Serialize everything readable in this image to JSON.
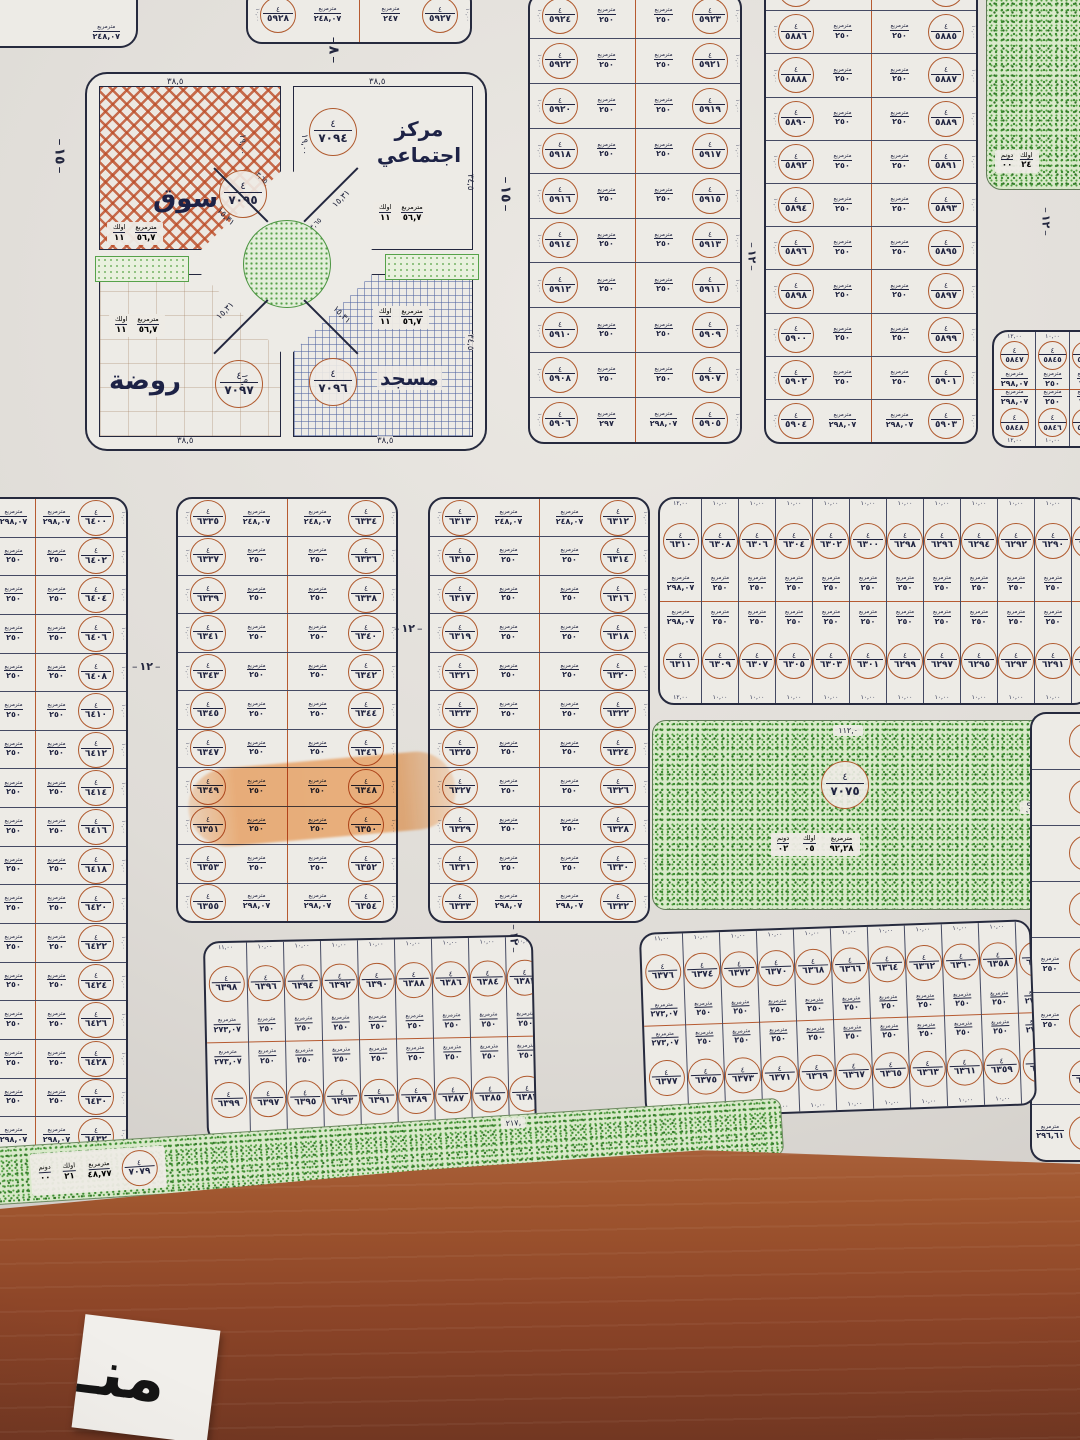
{
  "colors": {
    "paper": "#dfdcd7",
    "ink": "#1f2340",
    "plot_ring": "#b05a2e",
    "green": "#3c8a30",
    "brown_road": "#8d4528",
    "highlighter": "#f6923c"
  },
  "units": {
    "block_no": "٤",
    "m2": "مترمربع",
    "evlek": "اولك",
    "donum": "دونم"
  },
  "streets": {
    "w15": "١٥",
    "w8": "٨",
    "w12": "١٢"
  },
  "misc": {
    "corner_area": "٢٤٨,٠٧",
    "strip_length": "٢١٧,",
    "park_top_dim": "١١٢,٠",
    "park_side_dim": "٥٠,",
    "east_plot_no": "٦٢٧٧",
    "east_plot_area": "٢٩٦,٦١"
  },
  "bottom_label": {
    "text": "منـ"
  },
  "services": {
    "unit_stamp": [
      [
        "مترمربع",
        "٥٦,٧"
      ],
      [
        "اولك",
        "١١"
      ]
    ],
    "market": {
      "name": "سوق",
      "no": "٧٠٩٥",
      "dim_top": "٣٨,٥",
      "dim_side": "١٩,٠٠",
      "dim_diag": "١٥,٣١",
      "dim_chamfer": "٣,٦٥"
    },
    "community_center": {
      "name": "مركز اجتماعي",
      "no": "٧٠٩٤",
      "dim_top": "٣٨,٥",
      "dim_right": "٣٤,٥",
      "dim_side": "١٩,٠٠",
      "dim_diag": "١٥,٣١",
      "dim_chamfer": "٣,٦٥"
    },
    "kindergarten": {
      "name": "روضة",
      "no": "٧٠٩٧",
      "dim_top": "٢٤,٠٠",
      "dim_bottom": "٣٨,٥",
      "dim_side": "١٩,٠٠",
      "dim_diag": "١٥,٣١"
    },
    "mosque": {
      "name": "مسجد",
      "no": "٧٠٩٦",
      "dim_top": "٢٤,٠٠",
      "dim_bottom": "٣٨,٥",
      "dim_right": "٣٤,٥",
      "dim_diag": "١٥,٣١"
    }
  },
  "parks": {
    "central": {
      "no": "٧٠٧٥",
      "units": [
        [
          "مترمربع",
          "٩٢,٢٨"
        ],
        [
          "اولك",
          "٠٥"
        ],
        [
          "دونم",
          "٠٢"
        ]
      ]
    },
    "south_strip": {
      "no": "٧٠٧٩",
      "units": [
        [
          "مترمربع",
          "٤٨,٧٧"
        ],
        [
          "اولك",
          "٢١"
        ],
        [
          "دونم",
          "٠٠"
        ]
      ]
    },
    "ne_patch": {
      "units": [
        [
          "اولك",
          "٢٤"
        ],
        [
          "دونم",
          "٠٠"
        ]
      ]
    }
  },
  "blocks": {
    "nw_partial": {
      "edge": "١٠,٠٠",
      "area": "٢٥٠",
      "rows": [
        [
          "٥٩٢٨",
          "٥٩٢٧",
          "٢٤٨,٠٧",
          "٢٤٧"
        ]
      ]
    },
    "north_mid": {
      "edge": "١٠,٠٠",
      "area": "٢٥٠",
      "rows": [
        [
          "٥٩٢٤",
          "٥٩٢٣",
          null,
          null
        ],
        [
          "٥٩٢٢",
          "٥٩٢١",
          null,
          null
        ],
        [
          "٥٩٢٠",
          "٥٩١٩",
          null,
          null
        ],
        [
          "٥٩١٨",
          "٥٩١٧",
          null,
          null
        ],
        [
          "٥٩١٦",
          "٥٩١٥",
          null,
          null
        ],
        [
          "٥٩١٤",
          "٥٩١٣",
          null,
          null
        ],
        [
          "٥٩١٢",
          "٥٩١١",
          null,
          null
        ],
        [
          "٥٩١٠",
          "٥٩٠٩",
          null,
          null
        ],
        [
          "٥٩٠٨",
          "٥٩٠٧",
          null,
          null
        ],
        [
          "٥٩٠٦",
          "٥٩٠٥",
          "٢٩٧",
          "٢٩٨,٠٧"
        ]
      ]
    },
    "north_right": {
      "edge": "١٠,٠٠",
      "area": "٢٥٠",
      "rows": [
        [
          "٥٨٨٤",
          "٥٨٨٣",
          "٢٤٨,٠٧",
          "٢٤٨,٠٧"
        ],
        [
          "٥٨٨٦",
          "٥٨٨٥",
          null,
          null
        ],
        [
          "٥٨٨٨",
          "٥٨٨٧",
          null,
          null
        ],
        [
          "٥٨٩٠",
          "٥٨٨٩",
          null,
          null
        ],
        [
          "٥٨٩٢",
          "٥٨٩١",
          null,
          null
        ],
        [
          "٥٨٩٤",
          "٥٨٩٣",
          null,
          null
        ],
        [
          "٥٨٩٦",
          "٥٨٩٥",
          null,
          null
        ],
        [
          "٥٨٩٨",
          "٥٨٩٧",
          null,
          null
        ],
        [
          "٥٩٠٠",
          "٥٨٩٩",
          null,
          null
        ],
        [
          "٥٩٠٢",
          "٥٩٠١",
          null,
          null
        ],
        [
          "٥٩٠٤",
          "٥٩٠٣",
          "٢٩٨,٠٧",
          "٢٩٨,٠٧"
        ]
      ]
    },
    "northeast_small": {
      "width": "١٠,٠٠",
      "area": "٢٥٠",
      "cols": [
        [
          "٥٨٤٧",
          "٥٨٤٨",
          "٢٩٨,٠٧",
          "١٢,٠٠"
        ],
        [
          "٥٨٤٥",
          "٥٨٤٦",
          null,
          null
        ],
        [
          "٥٨٤٣",
          "٥٨٤٤",
          null,
          null
        ]
      ]
    },
    "west_strip": {
      "edge": "١٠,٠٠",
      "area": "٢٥٠",
      "rows": [
        [
          "٦٤٠١",
          "٦٤٠٠",
          "٢٩٨,٠٧",
          "٢٩٨,٠٧"
        ],
        [
          "٦٤٠٣",
          "٦٤٠٢",
          null,
          null
        ],
        [
          "٦٤٠٥",
          "٦٤٠٤",
          null,
          null
        ],
        [
          "٦٤٠٧",
          "٦٤٠٦",
          null,
          null
        ],
        [
          "٦٤٠٩",
          "٦٤٠٨",
          null,
          null
        ],
        [
          "٦٤١١",
          "٦٤١٠",
          null,
          null
        ],
        [
          "٦٤١٣",
          "٦٤١٢",
          null,
          null
        ],
        [
          "٦٤١٥",
          "٦٤١٤",
          null,
          null
        ],
        [
          "٦٤١٧",
          "٦٤١٦",
          null,
          null
        ],
        [
          "٦٤١٩",
          "٦٤١٨",
          null,
          null
        ],
        [
          "٦٤٢١",
          "٦٤٢٠",
          null,
          null
        ],
        [
          "٦٤٢٣",
          "٦٤٢٢",
          null,
          null
        ],
        [
          "٦٤٢٥",
          "٦٤٢٤",
          null,
          null
        ],
        [
          "٦٤٢٧",
          "٦٤٢٦",
          null,
          null
        ],
        [
          "٦٤٢٩",
          "٦٤٢٨",
          null,
          null
        ],
        [
          "٦٤٣١",
          "٦٤٣٠",
          null,
          null
        ],
        [
          "٦٤٣٣",
          "٦٤٣٢",
          "٢٩٨,٠٧",
          "٢٩٨,٠٧"
        ]
      ]
    },
    "mid_left": {
      "edge": "١٠,٠٠",
      "area": "٢٥٠",
      "rows": [
        [
          "٦٣٣٥",
          "٦٣٣٤",
          "٢٤٨,٠٧",
          "٢٤٨,٠٧"
        ],
        [
          "٦٣٣٧",
          "٦٣٣٦",
          null,
          null
        ],
        [
          "٦٣٣٩",
          "٦٣٣٨",
          null,
          null
        ],
        [
          "٦٣٤١",
          "٦٣٤٠",
          null,
          null
        ],
        [
          "٦٣٤٣",
          "٦٣٤٢",
          null,
          null
        ],
        [
          "٦٣٤٥",
          "٦٣٤٤",
          null,
          null
        ],
        [
          "٦٣٤٧",
          "٦٣٤٦",
          null,
          null
        ],
        [
          "٦٣٤٩",
          "٦٣٤٨",
          null,
          null
        ],
        [
          "٦٣٥١",
          "٦٣٥٠",
          null,
          null
        ],
        [
          "٦٣٥٣",
          "٦٣٥٢",
          null,
          null
        ],
        [
          "٦٣٥٥",
          "٦٣٥٤",
          "٢٩٨,٠٧",
          "٢٩٨,٠٧"
        ]
      ]
    },
    "mid_center": {
      "edge": "١٠,٠٠",
      "area": "٢٥٠",
      "rows": [
        [
          "٦٣١٣",
          "٦٣١٢",
          "٢٤٨,٠٧",
          "٢٤٨,٠٧"
        ],
        [
          "٦٣١٥",
          "٦٣١٤",
          null,
          null
        ],
        [
          "٦٣١٧",
          "٦٣١٦",
          null,
          null
        ],
        [
          "٦٣١٩",
          "٦٣١٨",
          null,
          null
        ],
        [
          "٦٣٢١",
          "٦٣٢٠",
          null,
          null
        ],
        [
          "٦٣٢٣",
          "٦٣٢٢",
          null,
          null
        ],
        [
          "٦٣٢٥",
          "٦٣٢٤",
          null,
          null
        ],
        [
          "٦٣٢٧",
          "٦٣٢٦",
          null,
          null
        ],
        [
          "٦٣٢٩",
          "٦٣٢٨",
          null,
          null
        ],
        [
          "٦٣٣١",
          "٦٣٣٠",
          null,
          null
        ],
        [
          "٦٣٣٣",
          "٦٣٣٢",
          "٢٩٨,٠٧",
          "٢٩٨,٠٧"
        ]
      ]
    },
    "mid_right_wide": {
      "width": "١٠,٠٠",
      "area": "٢٥٠",
      "cols": [
        [
          "٦٣١٠",
          "٦٣١١",
          "٢٩٨,٠٧",
          "١٢,٠٠"
        ],
        [
          "٦٣٠٨",
          "٦٣٠٩",
          null,
          null
        ],
        [
          "٦٣٠٦",
          "٦٣٠٧",
          null,
          null
        ],
        [
          "٦٣٠٤",
          "٦٣٠٥",
          null,
          null
        ],
        [
          "٦٣٠٢",
          "٦٣٠٣",
          null,
          null
        ],
        [
          "٦٣٠٠",
          "٦٣٠١",
          null,
          null
        ],
        [
          "٦٢٩٨",
          "٦٢٩٩",
          null,
          null
        ],
        [
          "٦٢٩٦",
          "٦٢٩٧",
          null,
          null
        ],
        [
          "٦٢٩٤",
          "٦٢٩٥",
          null,
          null
        ],
        [
          "٦٢٩٢",
          "٦٢٩٣",
          null,
          null
        ],
        [
          "٦٢٩٠",
          "٦٢٩١",
          null,
          null
        ],
        [
          "٦٢٨٨",
          "٦٢٨٩",
          null,
          null
        ],
        [
          "٦٢٨٦",
          "٦٢٨٧",
          null,
          null
        ]
      ]
    },
    "south_left": {
      "width": "١٠,٠٠",
      "area": "٢٥٠",
      "cols": [
        [
          "٦٣٩٨",
          "٦٣٩٩",
          "٢٧٣,٠٧",
          "١١,٠٠"
        ],
        [
          "٦٣٩٦",
          "٦٣٩٧",
          null,
          null
        ],
        [
          "٦٣٩٤",
          "٦٣٩٥",
          null,
          null
        ],
        [
          "٦٣٩٢",
          "٦٣٩٣",
          null,
          null
        ],
        [
          "٦٣٩٠",
          "٦٣٩١",
          null,
          null
        ],
        [
          "٦٣٨٨",
          "٦٣٨٩",
          null,
          null
        ],
        [
          "٦٣٨٦",
          "٦٣٨٧",
          null,
          null
        ],
        [
          "٦٣٨٤",
          "٦٣٨٥",
          null,
          null
        ],
        [
          "٦٣٨٢",
          "٦٣٨٣",
          null,
          null
        ],
        [
          "٦٣٨٠",
          "٦٣٨١",
          null,
          null
        ],
        [
          "٦٣٧٨",
          "٦٣٧٩",
          "٢٧٣,٠٧",
          "١١,٠٠"
        ]
      ]
    },
    "south_right": {
      "width": "١٠,٠٠",
      "area": "٢٥٠",
      "cols": [
        [
          "٦٣٧٦",
          "٦٣٧٧",
          "٢٧٣,٠٧",
          "١١,٠٠"
        ],
        [
          "٦٣٧٤",
          "٦٣٧٥",
          null,
          null
        ],
        [
          "٦٣٧٢",
          "٦٣٧٣",
          null,
          null
        ],
        [
          "٦٣٧٠",
          "٦٣٧١",
          null,
          null
        ],
        [
          "٦٣٦٨",
          "٦٣٦٩",
          null,
          null
        ],
        [
          "٦٣٦٦",
          "٦٣٦٧",
          null,
          null
        ],
        [
          "٦٣٦٤",
          "٦٣٦٥",
          null,
          null
        ],
        [
          "٦٣٦٢",
          "٦٣٦٣",
          null,
          null
        ],
        [
          "٦٣٦٠",
          "٦٣٦١",
          null,
          null
        ],
        [
          "٦٣٥٨",
          "٦٣٥٩",
          null,
          null
        ],
        [
          "٦٣٥٦",
          "٦٣٥٧",
          "٢٧٣,٠٧",
          "١١,٠٠"
        ]
      ]
    },
    "east_strip": {
      "rows": [
        [
          "",
          ""
        ],
        [
          "",
          ""
        ],
        [
          "",
          ""
        ],
        [
          "",
          ""
        ],
        [
          "٢٥٠",
          ""
        ],
        [
          "٢٥٠",
          ""
        ],
        [
          "",
          "٦٢٧٧"
        ],
        [
          "٢٩٦,٦١",
          ""
        ]
      ]
    }
  }
}
